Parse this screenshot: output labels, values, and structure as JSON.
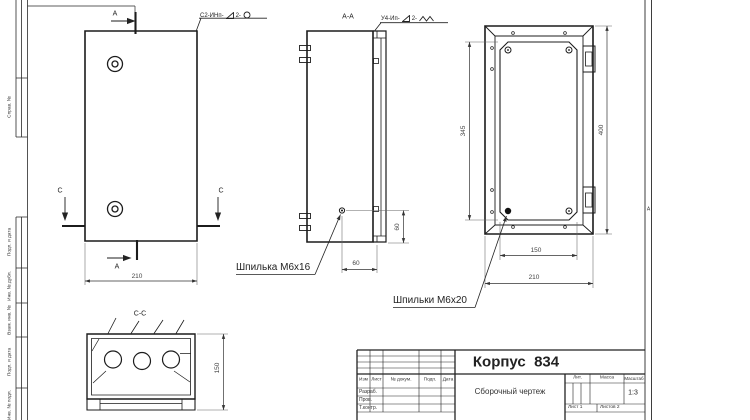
{
  "drawing": {
    "title": "Корпус  834",
    "subtitle": "Сборочный чертеж"
  },
  "title_block": {
    "headers": {
      "izm": "Изм",
      "list": "Лист",
      "doc": "№ докум.",
      "podp": "Подп.",
      "data": "Дата"
    },
    "rows": [
      "Разраб.",
      "Пров.",
      "Т.контр."
    ],
    "lit": "Лит.",
    "mass": "Масса",
    "scale_label": "Масштаб",
    "scale": "1:3",
    "sheet": "Лист 1",
    "sheets": "Листов 2"
  },
  "margin": {
    "labels": [
      "Справ. №",
      "Подп. и дата",
      "Инв. № дубл.",
      "Взам. инв. №",
      "Подп. и дата",
      "Инв. № подл."
    ],
    "zone": "А"
  },
  "views": {
    "front": {
      "label_a": "А",
      "label_c": "С",
      "dim_width": "210"
    },
    "section_aa": {
      "label": "А-А",
      "dim_offset_vertical": "60",
      "dim_offset_horizontal": "60"
    },
    "back": {
      "dim_plate_height": "345",
      "dim_height": "400",
      "dim_plate_width": "150",
      "dim_width": "210"
    },
    "section_cc": {
      "label": "С-С",
      "dim_depth": "150"
    }
  },
  "annotations": {
    "stud_single": "Шпилька М6х16",
    "stud_multi": "Шпильки М6х20"
  },
  "weld_notes": {
    "n1_prefix": "С2-ИНп-",
    "n1_mid": "2-",
    "n2_prefix": "У4-Ип-",
    "n2_mid": "2-"
  }
}
